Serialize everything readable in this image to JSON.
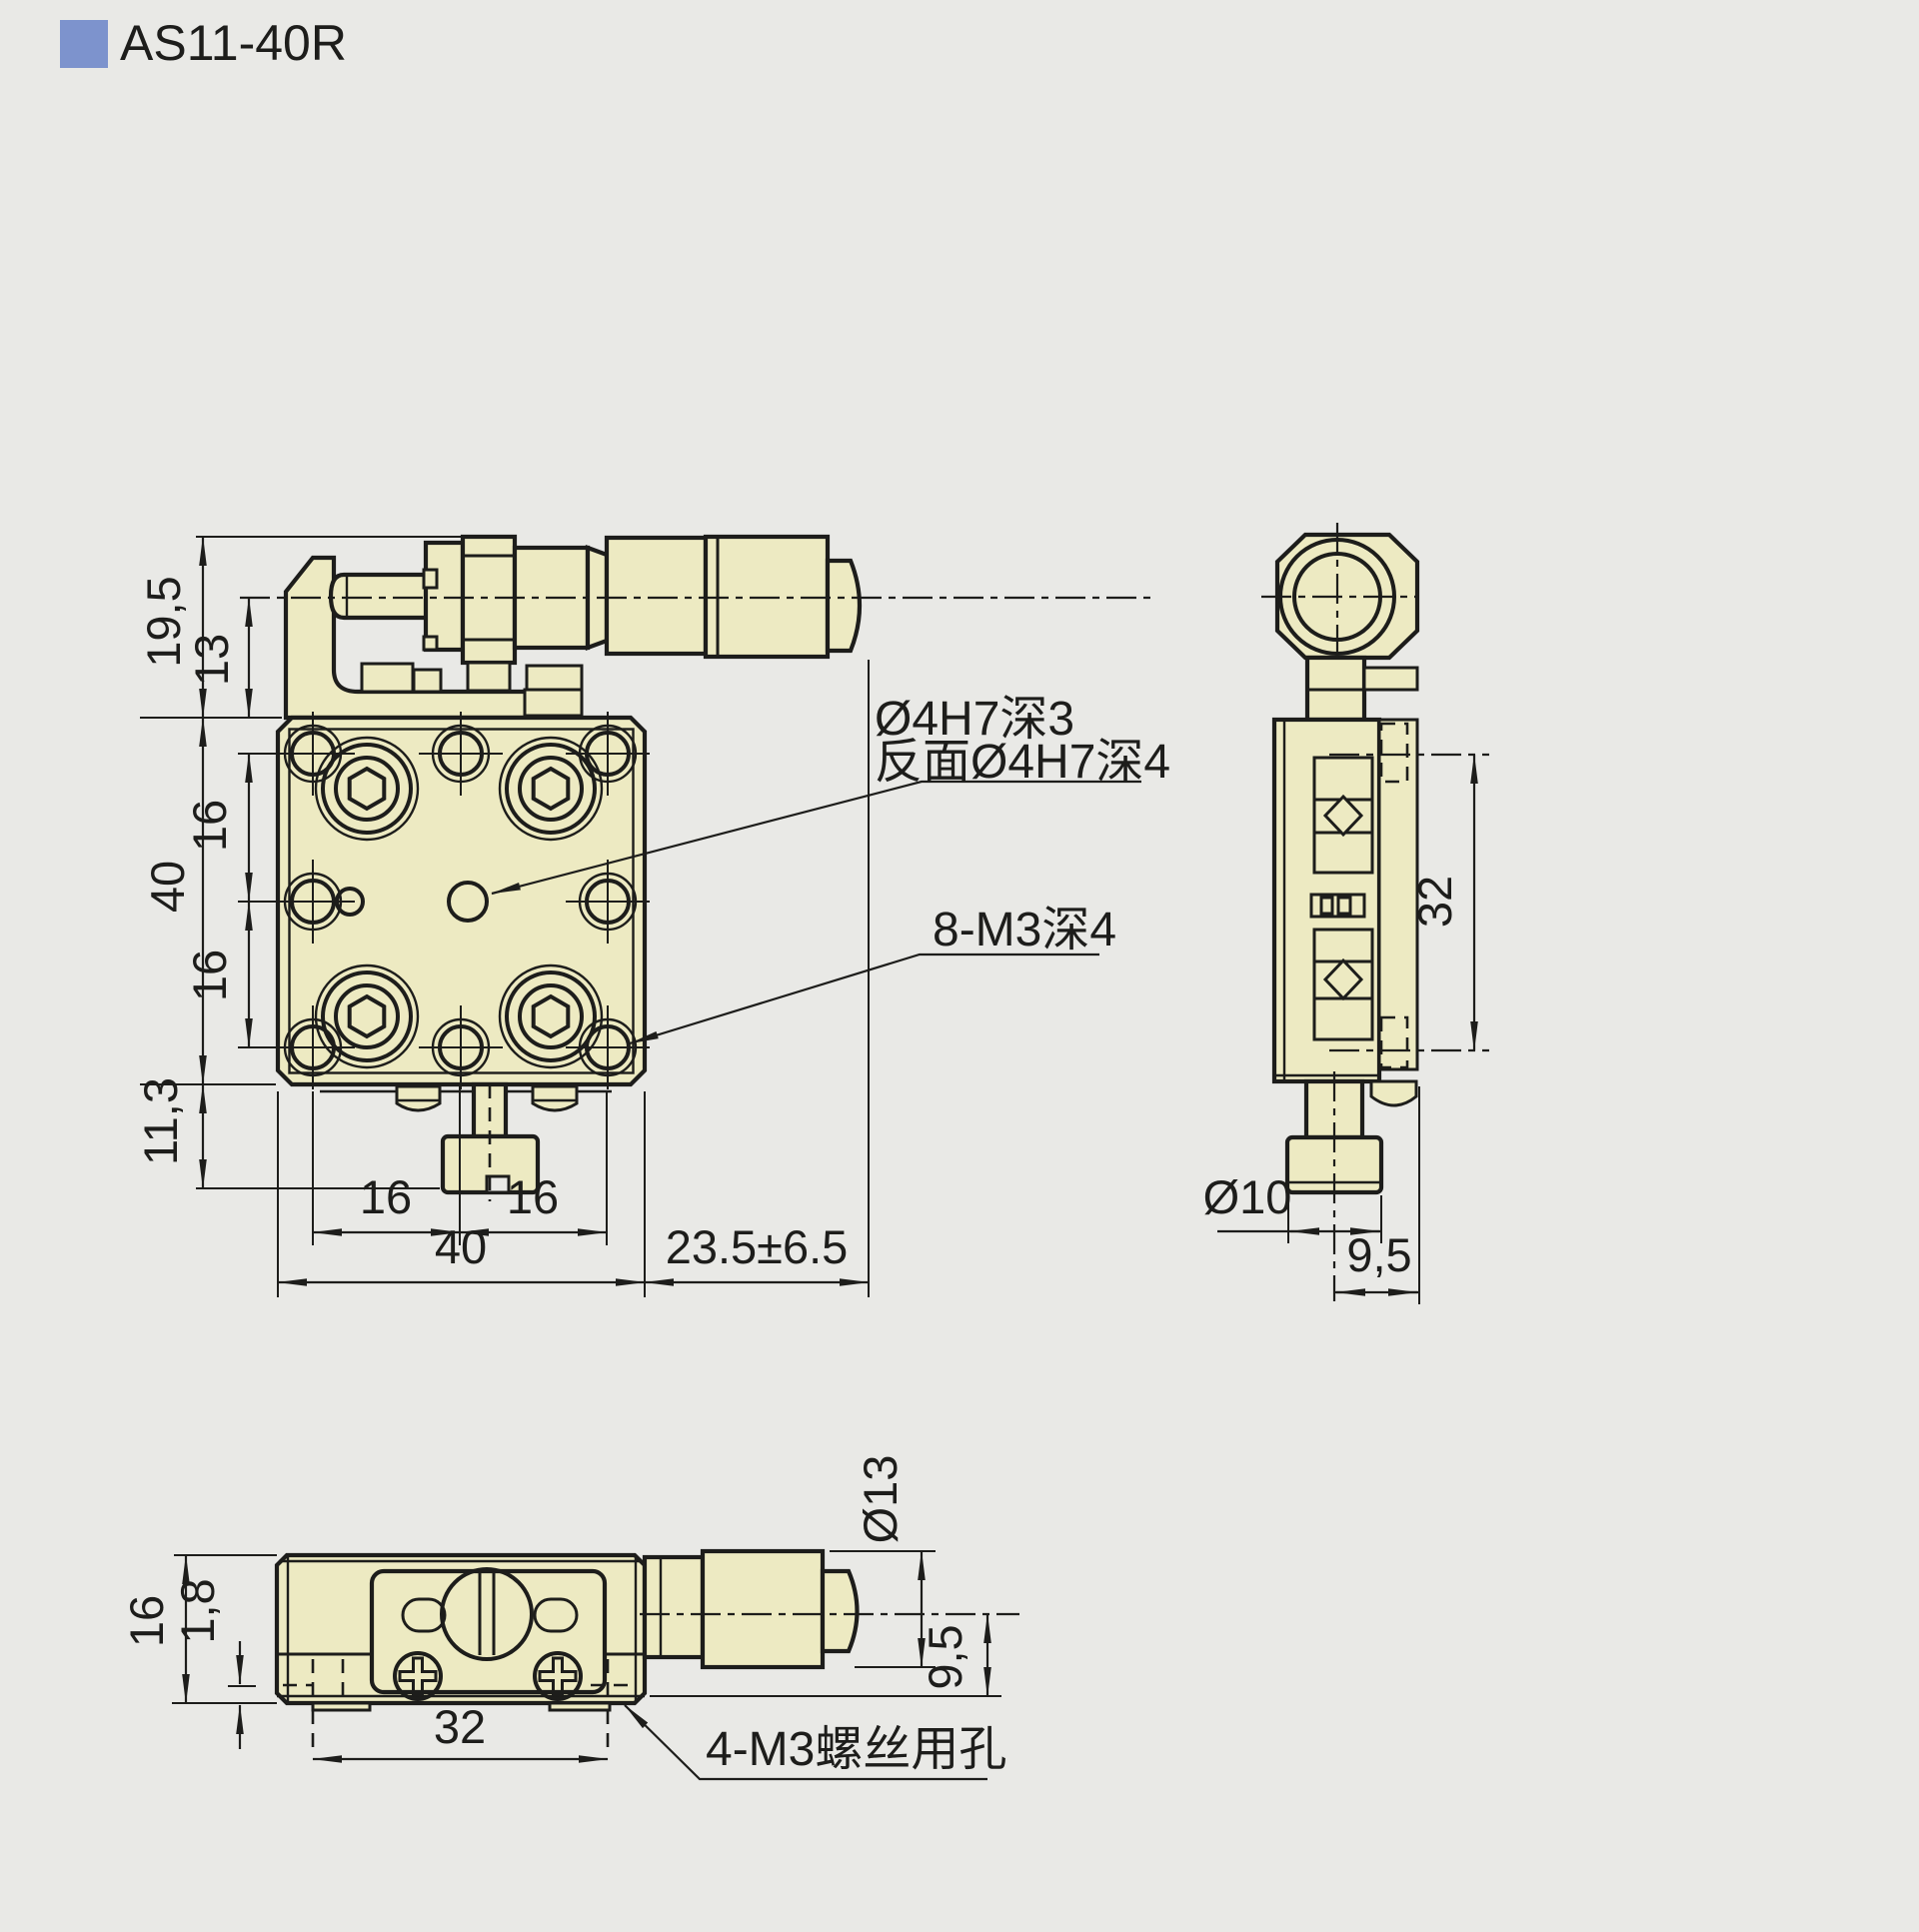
{
  "title": "AS11-40R",
  "colors": {
    "background": "#e9e9e6",
    "part_fill": "#edeac2",
    "line": "#1d1d1b",
    "accent": "#7d93cd"
  },
  "front_view": {
    "dims": {
      "bracket_height": "19,5",
      "spindle_offset": "13",
      "hole_pitch_top": "16",
      "plate_height": "40",
      "hole_pitch_bottom": "16",
      "knob_drop": "11,3",
      "hole_pitch_left": "16",
      "hole_pitch_right": "16",
      "plate_width": "40",
      "micrometer_travel": "23.5±6.5"
    },
    "labels": {
      "center_hole_line1": "Ø4H7深3",
      "center_hole_line2": "反面Ø4H7深4",
      "thread_holes": "8-M3深4"
    }
  },
  "side_view": {
    "dims": {
      "slide_span": "32",
      "knob_dia": "Ø10",
      "knob_offset": "9,5"
    }
  },
  "bottom_view": {
    "dims": {
      "body_height": "16",
      "base_plate": "1,8",
      "screw_pitch": "32",
      "thimble_dia": "Ø13",
      "axis_offset": "9,5"
    },
    "labels": {
      "mount_holes": "4-M3螺丝用孔"
    }
  }
}
